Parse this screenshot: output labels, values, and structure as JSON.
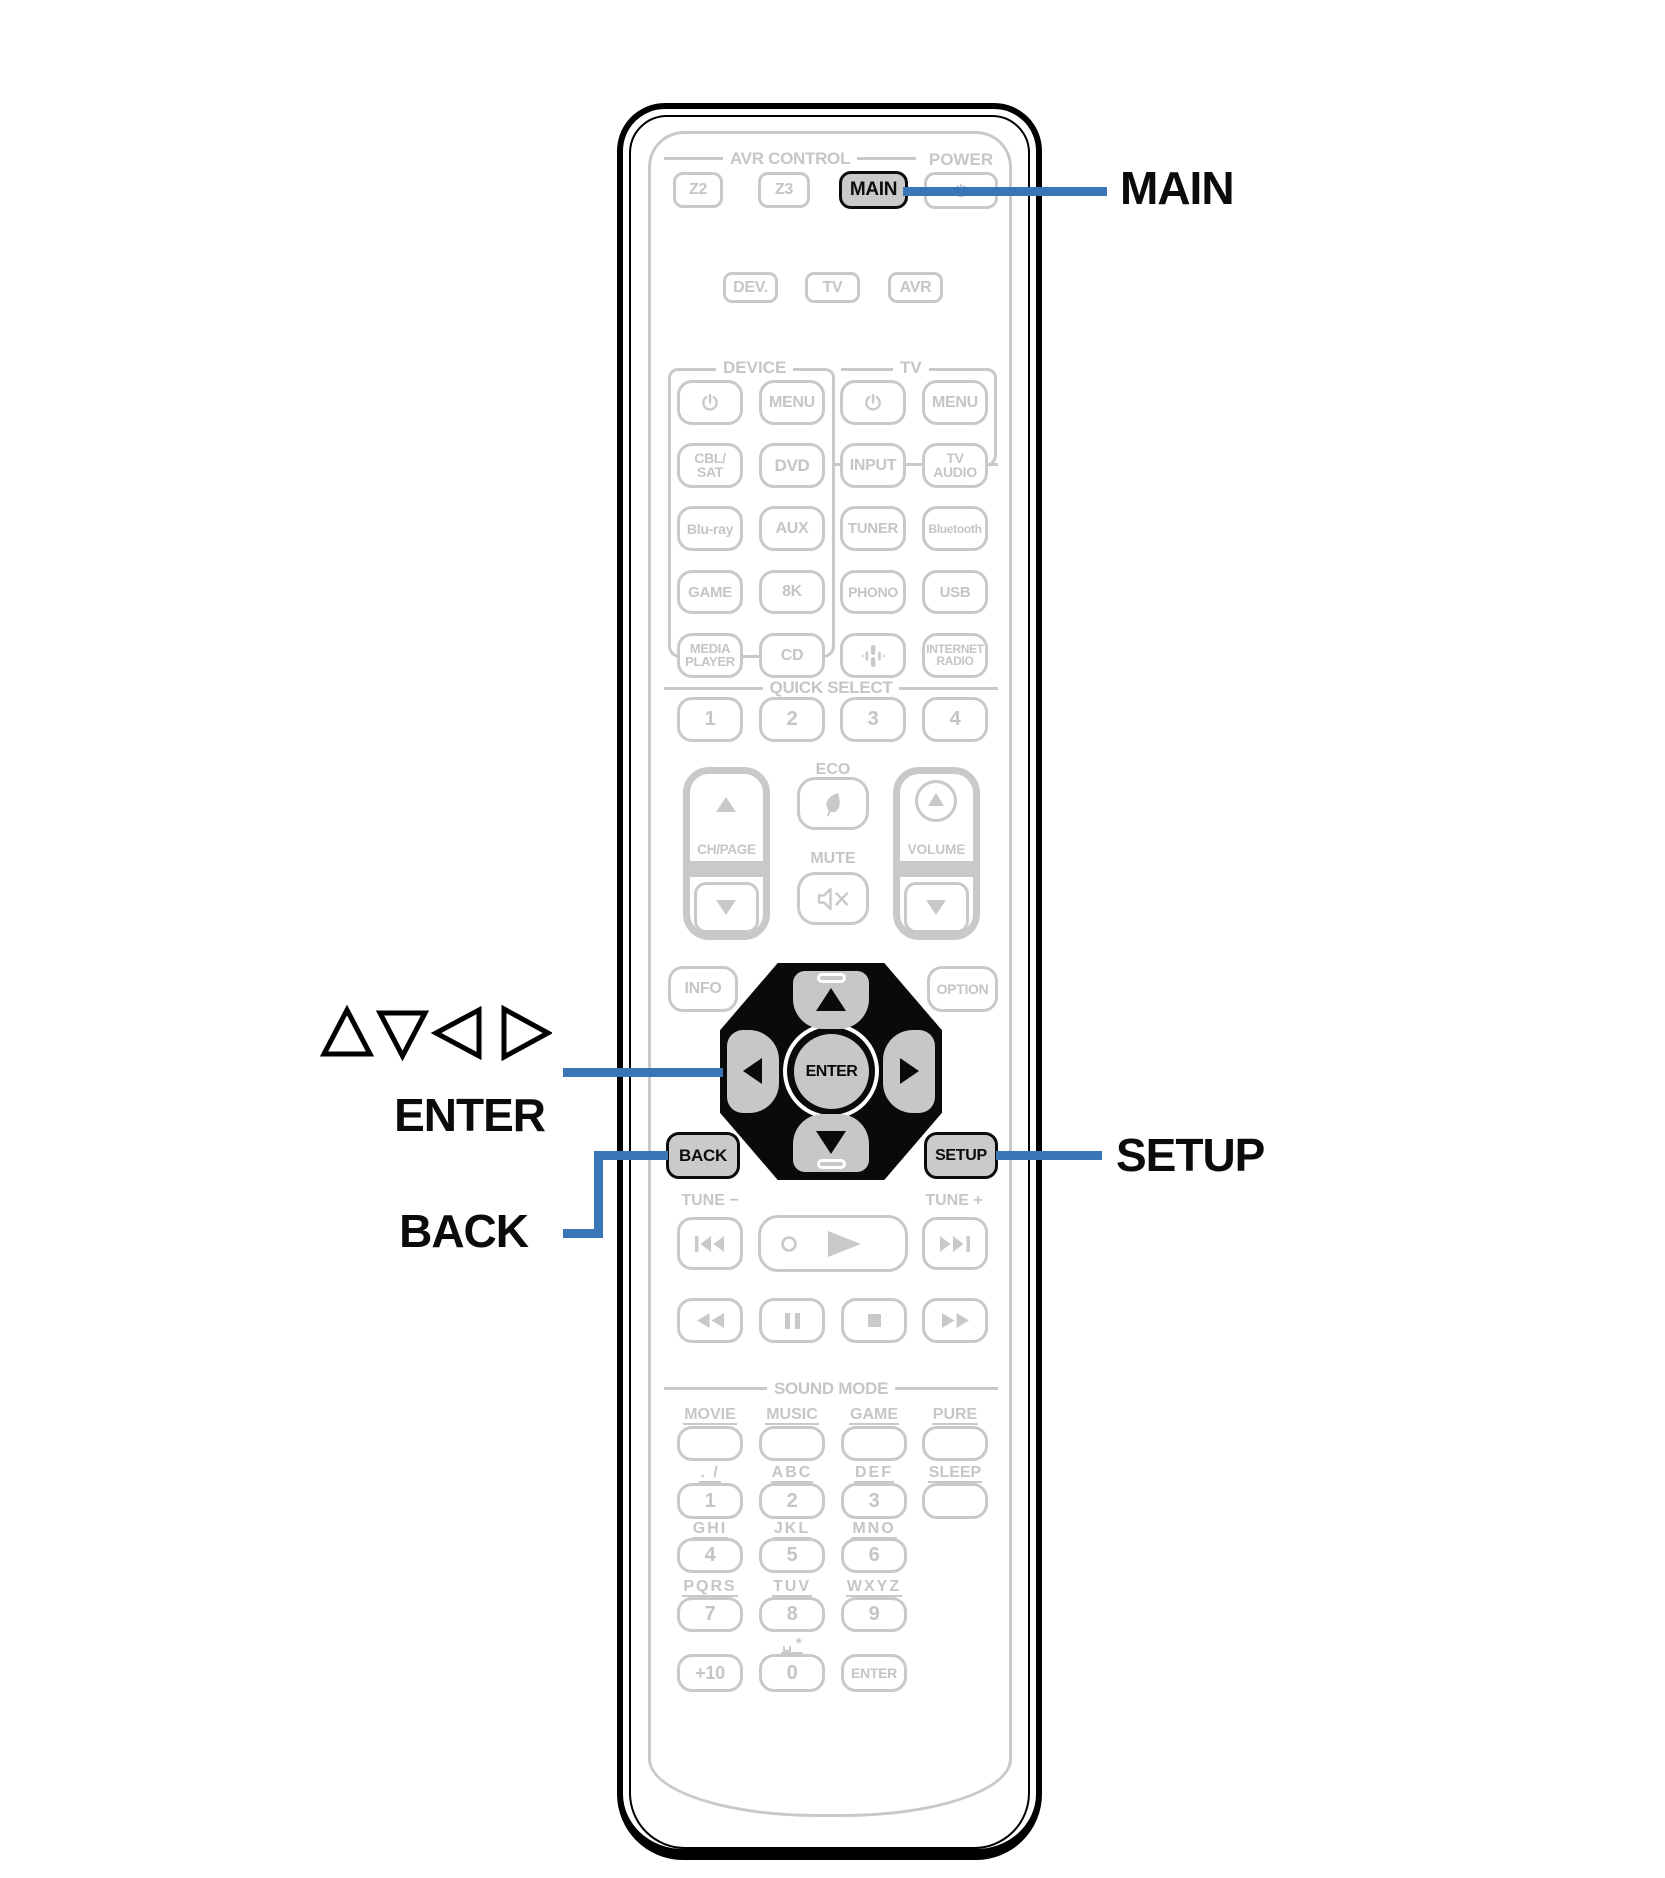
{
  "colors": {
    "accent_blue": "#3a76b6",
    "faded_gray": "#c8c8c8",
    "key_fill": "#cacaca",
    "pad_black": "#0a0a0a"
  },
  "callouts": {
    "main": "MAIN",
    "setup": "SETUP",
    "enter": "ENTER",
    "back": "BACK",
    "arrows": "△▽◁ ▷"
  },
  "header": {
    "avr_control": "AVR CONTROL",
    "power": "POWER",
    "z2": "Z2",
    "z3": "Z3",
    "main": "MAIN"
  },
  "mode_row": {
    "dev": "DEV.",
    "tv": "TV",
    "avr": "AVR"
  },
  "groups": {
    "device": "DEVICE",
    "tv": "TV"
  },
  "keys": {
    "menu_device": "MENU",
    "menu_tv": "MENU",
    "cbl": [
      "CBL/",
      "SAT"
    ],
    "dvd": "DVD",
    "input": "INPUT",
    "tv_audio": [
      "TV",
      "AUDIO"
    ],
    "blu_ray": "Blu-ray",
    "aux": "AUX",
    "tuner": "TUNER",
    "bluetooth": "Bluetooth",
    "game": "GAME",
    "k8": "8K",
    "phono": "PHONO",
    "usb": "USB",
    "media_player": [
      "MEDIA",
      "PLAYER"
    ],
    "cd": "CD",
    "internet_radio": [
      "INTERNET",
      "RADIO"
    ]
  },
  "quick_select": {
    "label": "QUICK SELECT",
    "k1": "1",
    "k2": "2",
    "k3": "3",
    "k4": "4"
  },
  "volume_block": {
    "eco": "ECO",
    "mute": "MUTE",
    "ch_page": "CH/PAGE",
    "volume": "VOLUME"
  },
  "nav": {
    "info": "INFO",
    "option": "OPTION",
    "enter": "ENTER",
    "back": "BACK",
    "setup": "SETUP"
  },
  "tune": {
    "minus": "TUNE −",
    "plus": "TUNE +"
  },
  "sound_mode": {
    "label": "SOUND MODE",
    "movie": "MOVIE",
    "music": "MUSIC",
    "game": "GAME",
    "pure": "PURE"
  },
  "keypad": {
    "l1": ". /",
    "l2": "ABC",
    "l3": "DEF",
    "l_sleep": "SLEEP",
    "k1": "1",
    "k2": "2",
    "k3": "3",
    "l4": "GHI",
    "l5": "JKL",
    "l6": "MNO",
    "k4": "4",
    "k5": "5",
    "k6": "6",
    "l7": "PQRS",
    "l8": "TUV",
    "l9": "WXYZ",
    "k7": "7",
    "k8": "8",
    "k9": "9",
    "l0": "␣ *",
    "kplus10": "+10",
    "k0": "0",
    "kenter": "ENTER"
  }
}
